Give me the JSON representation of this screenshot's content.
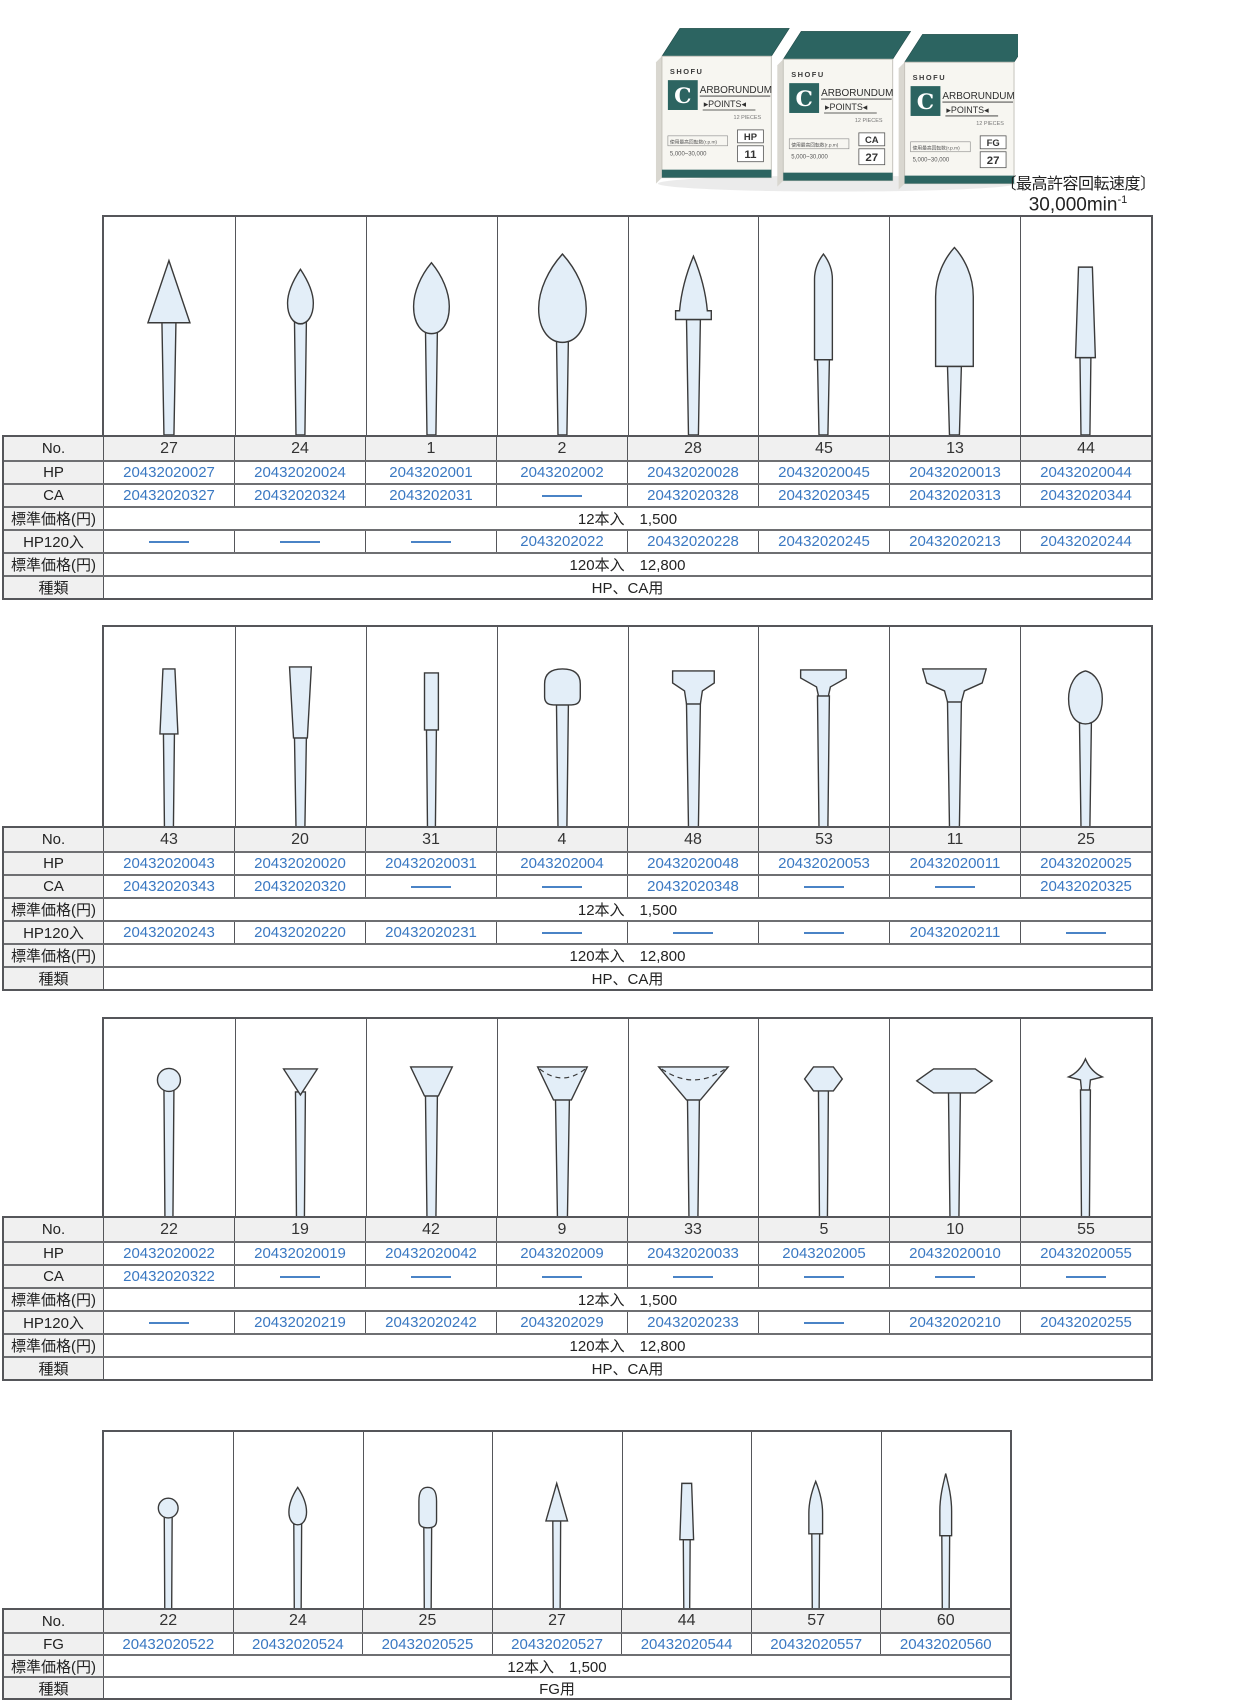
{
  "speed": {
    "note": "〔最高許容回転速度〕",
    "value": "30,000min",
    "sup": "-1"
  },
  "product_boxes": {
    "brand": "SHOFU",
    "logo_letter": "C",
    "title_top": "ARBORUNDUM",
    "title_bottom": "▸POINTS◂",
    "pieces": "12 PIECES",
    "spec_label": "使用最高回転数(r.p.m)",
    "spec_value": "5,000~30,000",
    "labels": [
      {
        "type": "HP",
        "no": "11"
      },
      {
        "type": "CA",
        "no": "27"
      },
      {
        "type": "FG",
        "no": "27"
      }
    ]
  },
  "tables": [
    {
      "shapes": [
        "cone-point",
        "bud-small",
        "teardrop-medium",
        "teardrop-large",
        "flame",
        "bullet-narrow",
        "torpedo",
        "taper-cylinder"
      ],
      "rows": [
        {
          "name": "no",
          "label": "No.",
          "kind": "num",
          "values": [
            "27",
            "24",
            "1",
            "2",
            "28",
            "45",
            "13",
            "44"
          ]
        },
        {
          "name": "hp",
          "label": "HP",
          "kind": "code",
          "values": [
            "20432020027",
            "20432020024",
            "2043202001",
            "2043202002",
            "20432020028",
            "20432020045",
            "20432020013",
            "20432020044"
          ]
        },
        {
          "name": "ca",
          "label": "CA",
          "kind": "code",
          "values": [
            "20432020327",
            "20432020324",
            "2043202031",
            "—",
            "20432020328",
            "20432020345",
            "20432020313",
            "20432020344"
          ]
        },
        {
          "name": "price12",
          "label": "標準価格(円)",
          "kind": "merged",
          "value": "12本入　1,500"
        },
        {
          "name": "hp120",
          "label": "HP120入",
          "kind": "code",
          "values": [
            "—",
            "—",
            "—",
            "2043202022",
            "20432020228",
            "20432020245",
            "20432020213",
            "20432020244"
          ]
        },
        {
          "name": "price120",
          "label": "標準価格(円)",
          "kind": "merged",
          "value": "120本入　12,800"
        },
        {
          "name": "type",
          "label": "種類",
          "kind": "merged",
          "value": "HP、CA用"
        }
      ]
    },
    {
      "shapes": [
        "taper-small",
        "trapezoid",
        "cylinder-small",
        "mushroom",
        "tee-small",
        "tee-flat",
        "tee-wide",
        "egg"
      ],
      "rows": [
        {
          "name": "no",
          "label": "No.",
          "kind": "num",
          "values": [
            "43",
            "20",
            "31",
            "4",
            "48",
            "53",
            "11",
            "25"
          ]
        },
        {
          "name": "hp",
          "label": "HP",
          "kind": "code",
          "values": [
            "20432020043",
            "20432020020",
            "20432020031",
            "2043202004",
            "20432020048",
            "20432020053",
            "20432020011",
            "20432020025"
          ]
        },
        {
          "name": "ca",
          "label": "CA",
          "kind": "code",
          "values": [
            "20432020343",
            "20432020320",
            "—",
            "—",
            "20432020348",
            "—",
            "—",
            "20432020325"
          ]
        },
        {
          "name": "price12",
          "label": "標準価格(円)",
          "kind": "merged",
          "value": "12本入　1,500"
        },
        {
          "name": "hp120",
          "label": "HP120入",
          "kind": "code",
          "values": [
            "20432020243",
            "20432020220",
            "20432020231",
            "—",
            "—",
            "—",
            "20432020211",
            "—"
          ]
        },
        {
          "name": "price120",
          "label": "標準価格(円)",
          "kind": "merged",
          "value": "120本入　12,800"
        },
        {
          "name": "type",
          "label": "種類",
          "kind": "merged",
          "value": "HP、CA用"
        }
      ]
    },
    {
      "shapes": [
        "ball",
        "inverted-cone",
        "inverted-trapezoid",
        "cup",
        "cup-wide",
        "hexagon-small",
        "lens-wide",
        "spear"
      ],
      "rows": [
        {
          "name": "no",
          "label": "No.",
          "kind": "num",
          "values": [
            "22",
            "19",
            "42",
            "9",
            "33",
            "5",
            "10",
            "55"
          ]
        },
        {
          "name": "hp",
          "label": "HP",
          "kind": "code",
          "values": [
            "20432020022",
            "20432020019",
            "20432020042",
            "2043202009",
            "20432020033",
            "2043202005",
            "20432020010",
            "20432020055"
          ]
        },
        {
          "name": "ca",
          "label": "CA",
          "kind": "code",
          "values": [
            "20432020322",
            "—",
            "—",
            "—",
            "—",
            "—",
            "—",
            "—"
          ]
        },
        {
          "name": "price12",
          "label": "標準価格(円)",
          "kind": "merged",
          "value": "12本入　1,500"
        },
        {
          "name": "hp120",
          "label": "HP120入",
          "kind": "code",
          "values": [
            "—",
            "20432020219",
            "20432020242",
            "2043202029",
            "20432020233",
            "—",
            "20432020210",
            "20432020255"
          ]
        },
        {
          "name": "price120",
          "label": "標準価格(円)",
          "kind": "merged",
          "value": "120本入　12,800"
        },
        {
          "name": "type",
          "label": "種類",
          "kind": "merged",
          "value": "HP、CA用"
        }
      ]
    },
    {
      "shapes": [
        "ball-small",
        "bud-tiny",
        "bullet-tiny",
        "cone-tiny",
        "taper-tiny",
        "flame-slim",
        "flame-slim-tall"
      ],
      "rows": [
        {
          "name": "no",
          "label": "No.",
          "kind": "num",
          "values": [
            "22",
            "24",
            "25",
            "27",
            "44",
            "57",
            "60"
          ]
        },
        {
          "name": "fg",
          "label": "FG",
          "kind": "code",
          "values": [
            "20432020522",
            "20432020524",
            "20432020525",
            "20432020527",
            "20432020544",
            "20432020557",
            "20432020560"
          ]
        },
        {
          "name": "price12",
          "label": "標準価格(円)",
          "kind": "merged",
          "value": "12本入　1,500"
        },
        {
          "name": "type",
          "label": "種類",
          "kind": "merged",
          "value": "FG用"
        }
      ]
    }
  ]
}
